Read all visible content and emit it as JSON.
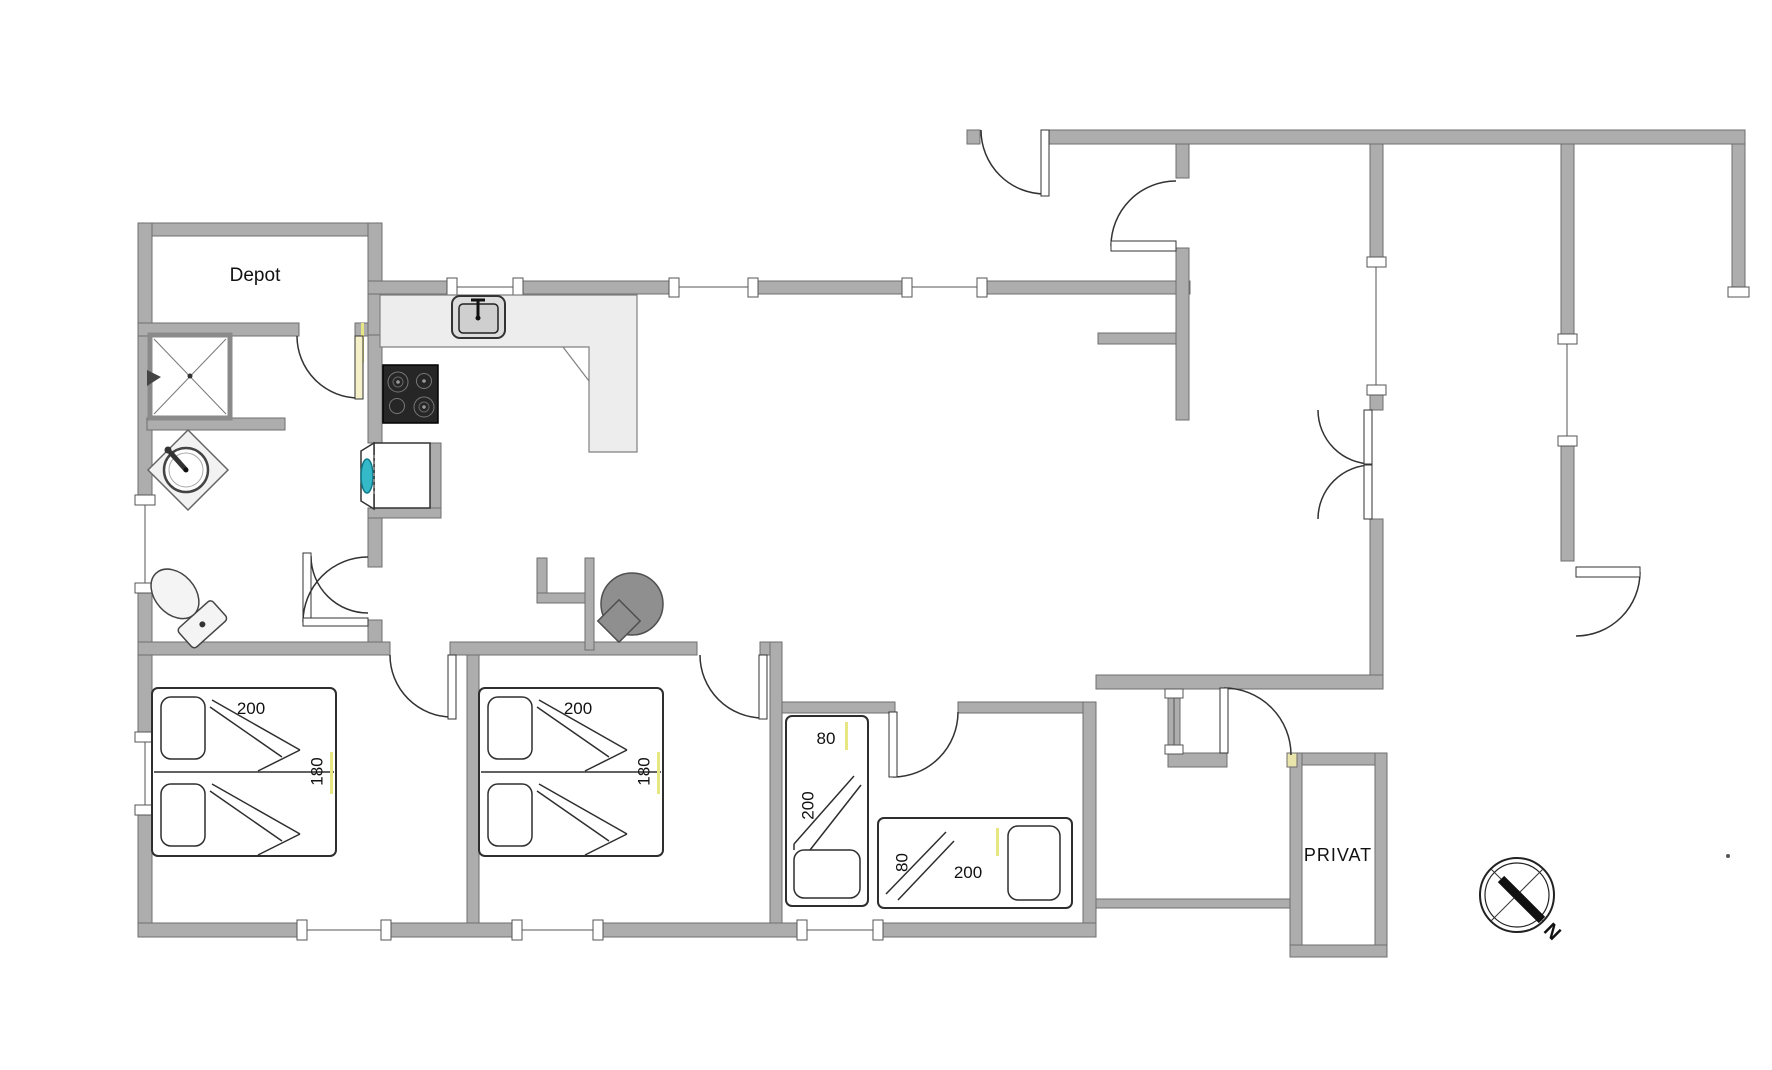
{
  "floor_plan": {
    "rooms": {
      "depot": "Depot",
      "privat": "PRIVAT"
    },
    "beds": {
      "double_bed_1": {
        "width_cm": "200",
        "length_cm": "180"
      },
      "double_bed_2": {
        "width_cm": "200",
        "length_cm": "180"
      },
      "single_bed_1": {
        "width_cm": "80",
        "length_cm": "200"
      },
      "single_bed_2": {
        "width_cm": "80",
        "length_cm": "200"
      }
    },
    "compass": {
      "north": "N"
    },
    "colors": {
      "wall": "#adadad",
      "wall_border": "#6e6e6e",
      "counter": "#ededed",
      "cooktop_dark": "#262626",
      "washer_teal": "#35b8c8",
      "wood_stove_gray": "#8f8f8f",
      "accent_yellow": "#e8e682"
    },
    "icons": [
      "shower-icon",
      "washbasin-icon",
      "toilet-icon",
      "kitchen-sink-icon",
      "cooktop-icon",
      "washing-machine-icon",
      "wood-stove-icon",
      "door-swing-icon",
      "window-icon",
      "compass-rose-icon"
    ]
  }
}
